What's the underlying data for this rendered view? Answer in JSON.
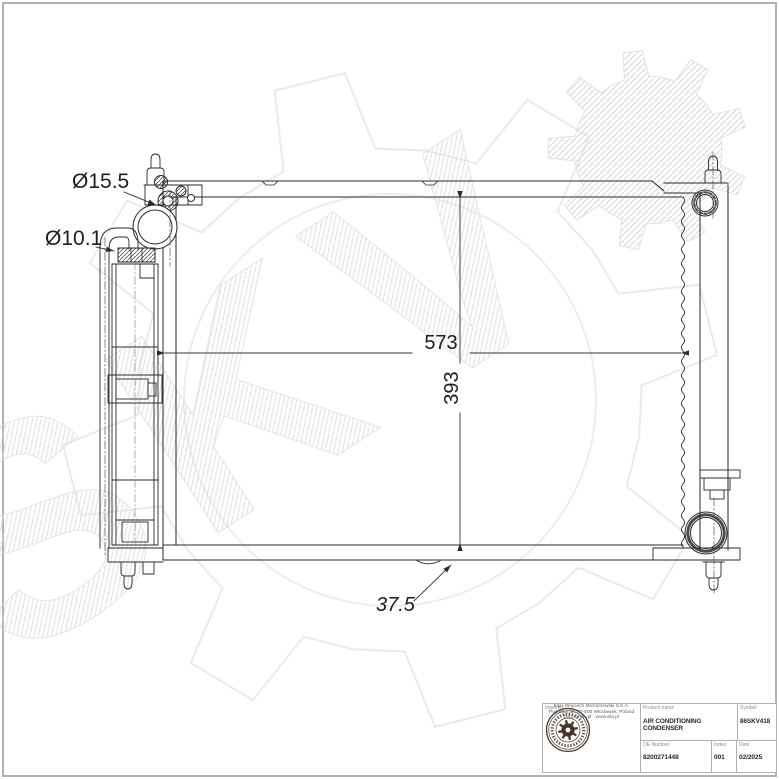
{
  "watermark": {
    "text": "SKV"
  },
  "drawing": {
    "labels": {
      "fitting_diameter": "Ø15.5",
      "pipe_diameter": "Ø10.1",
      "width": "573",
      "height": "393",
      "depth": "37.5"
    }
  },
  "title_block": {
    "importer_label": "Importer",
    "product_name_label": "Product name",
    "product_name": "AIR CONDITIONING CONDENSER",
    "symbol_label": "Symbol",
    "symbol": "86SKV418",
    "oe_number_label": "OE Number",
    "oe_number": "8200271448",
    "index_label": "Index",
    "index": "001",
    "date_label": "Date",
    "date": "02/2025",
    "company_lines": [
      "E&H Wojciech Michorzewski S.K.A.",
      "Pogodna 39, 87-800 Włocławek, Poland",
      "biuro@skv.pl · www.skv.pl"
    ]
  }
}
